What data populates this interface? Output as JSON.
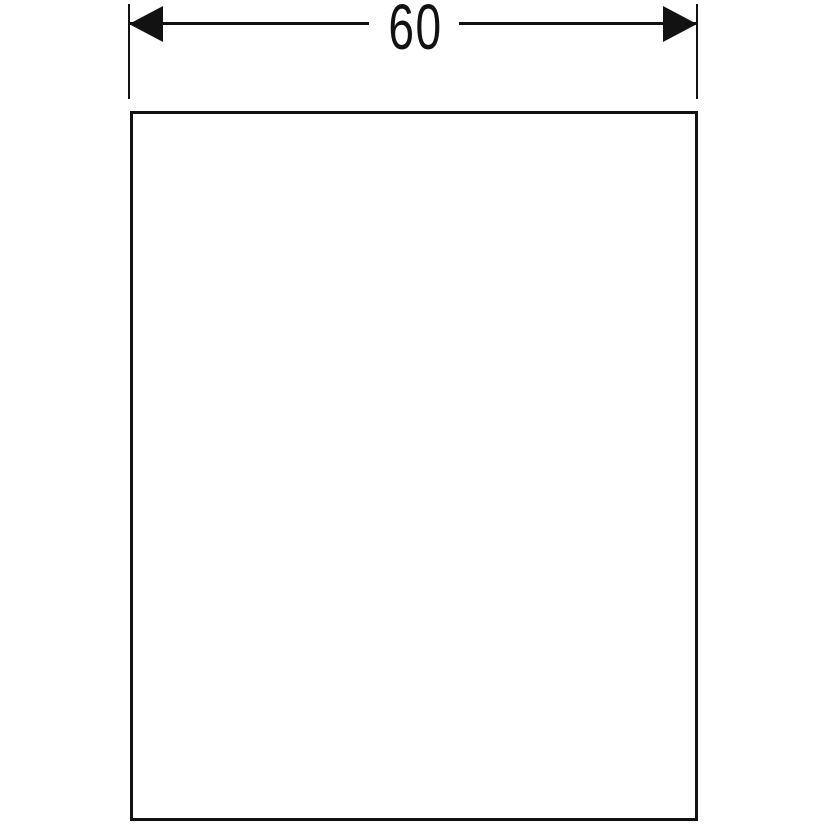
{
  "diagram": {
    "type": "technical-dimension-drawing",
    "dimension_label": "60",
    "colors": {
      "line": "#121212",
      "background": "#ffffff"
    }
  }
}
